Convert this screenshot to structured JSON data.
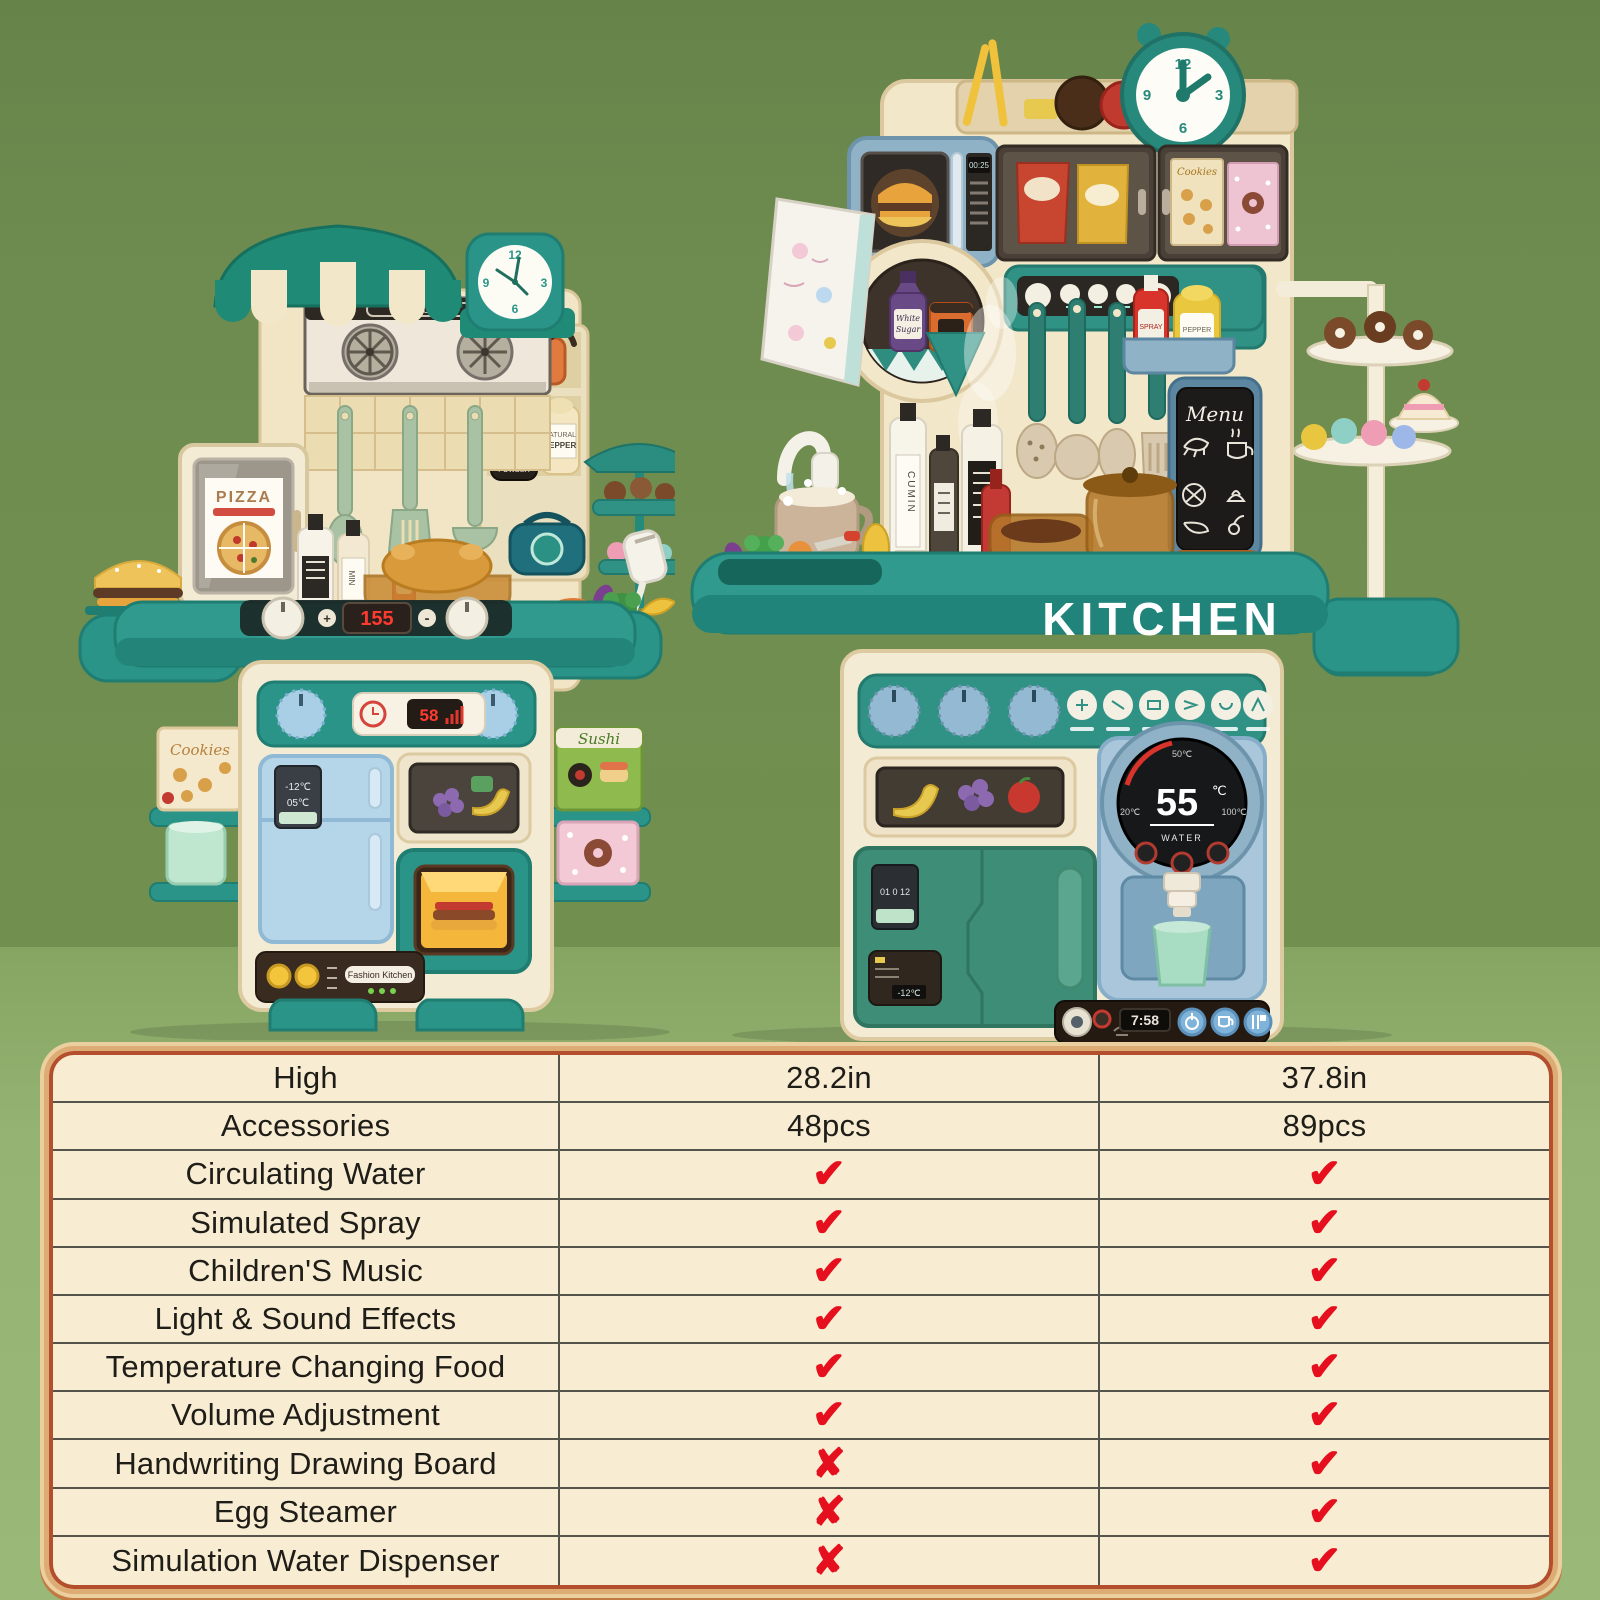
{
  "scene": {
    "wall_color": "#6f8c50",
    "floor_color": "#95b474",
    "accent_teal": "#2b9488",
    "accent_red": "#e60f1e",
    "table_bg": "#f8ecd2"
  },
  "kitchen_small": {
    "clock_numbers": [
      "12",
      "3",
      "6",
      "9"
    ],
    "welcome_sign": "WELCOME",
    "pizza_box_label": "PIZZA",
    "stove_display": "155",
    "stove_plus": "+",
    "stove_minus": "-",
    "panel_display": "58",
    "fridge_temp_top": "-12℃",
    "fridge_temp_bottom": "05℃",
    "brand_label": "Fashion Kitchen",
    "cookies_box_label": "Cookies",
    "sushi_box_label": "Sushi",
    "sauce_bottle_label": "MIN",
    "vanilla_bottle": [
      "VANILLA",
      "POWDER"
    ],
    "pepper_bottle": [
      "NATURAL",
      "PEPPER"
    ]
  },
  "kitchen_large": {
    "clock_numbers": [
      "12",
      "3",
      "6",
      "9"
    ],
    "microwave_display": "00:25",
    "menu_board_label": "Menu",
    "counter_label": "KITCHEN",
    "sugar_jar": [
      "White",
      "Sugar"
    ],
    "cumin_bottle_label": "CUMIN",
    "spray_bottle_label": "SPRAY",
    "pepper_bottle_label": "PEPPER",
    "cookies_box_label": "Cookies",
    "temp_display": {
      "top": "50℃",
      "value": "55",
      "unit": "℃",
      "min": "20℃",
      "max": "100℃",
      "label": "WATER"
    },
    "fridge_screen": "01 0 12",
    "fridge_temp": "-12℃",
    "time_display": "7:58"
  },
  "comparison_table": {
    "rows": [
      {
        "feature": "High",
        "small": "28.2in",
        "large": "37.8in"
      },
      {
        "feature": "Accessories",
        "small": "48pcs",
        "large": "89pcs"
      },
      {
        "feature": "Circulating Water",
        "small": "✔",
        "large": "✔"
      },
      {
        "feature": "Simulated Spray",
        "small": "✔",
        "large": "✔"
      },
      {
        "feature": "Children'S Music",
        "small": "✔",
        "large": "✔"
      },
      {
        "feature": "Light & Sound Effects",
        "small": "✔",
        "large": "✔"
      },
      {
        "feature": "Temperature Changing Food",
        "small": "✔",
        "large": "✔"
      },
      {
        "feature": "Volume Adjustment",
        "small": "✔",
        "large": "✔"
      },
      {
        "feature": "Handwriting Drawing Board",
        "small": "✘",
        "large": "✔"
      },
      {
        "feature": "Egg Steamer",
        "small": "✘",
        "large": "✔"
      },
      {
        "feature": "Simulation Water Dispenser",
        "small": "✘",
        "large": "✔"
      }
    ]
  },
  "chart_data": {
    "type": "table",
    "columns": [
      "Feature",
      "28.2in kitchen",
      "37.8in kitchen"
    ],
    "rows": [
      [
        "High",
        "28.2in",
        "37.8in"
      ],
      [
        "Accessories",
        "48pcs",
        "89pcs"
      ],
      [
        "Circulating Water",
        true,
        true
      ],
      [
        "Simulated Spray",
        true,
        true
      ],
      [
        "Children'S Music",
        true,
        true
      ],
      [
        "Light & Sound Effects",
        true,
        true
      ],
      [
        "Temperature Changing Food",
        true,
        true
      ],
      [
        "Volume Adjustment",
        true,
        true
      ],
      [
        "Handwriting Drawing Board",
        false,
        true
      ],
      [
        "Egg Steamer",
        false,
        true
      ],
      [
        "Simulation Water Dispenser",
        false,
        true
      ]
    ]
  }
}
